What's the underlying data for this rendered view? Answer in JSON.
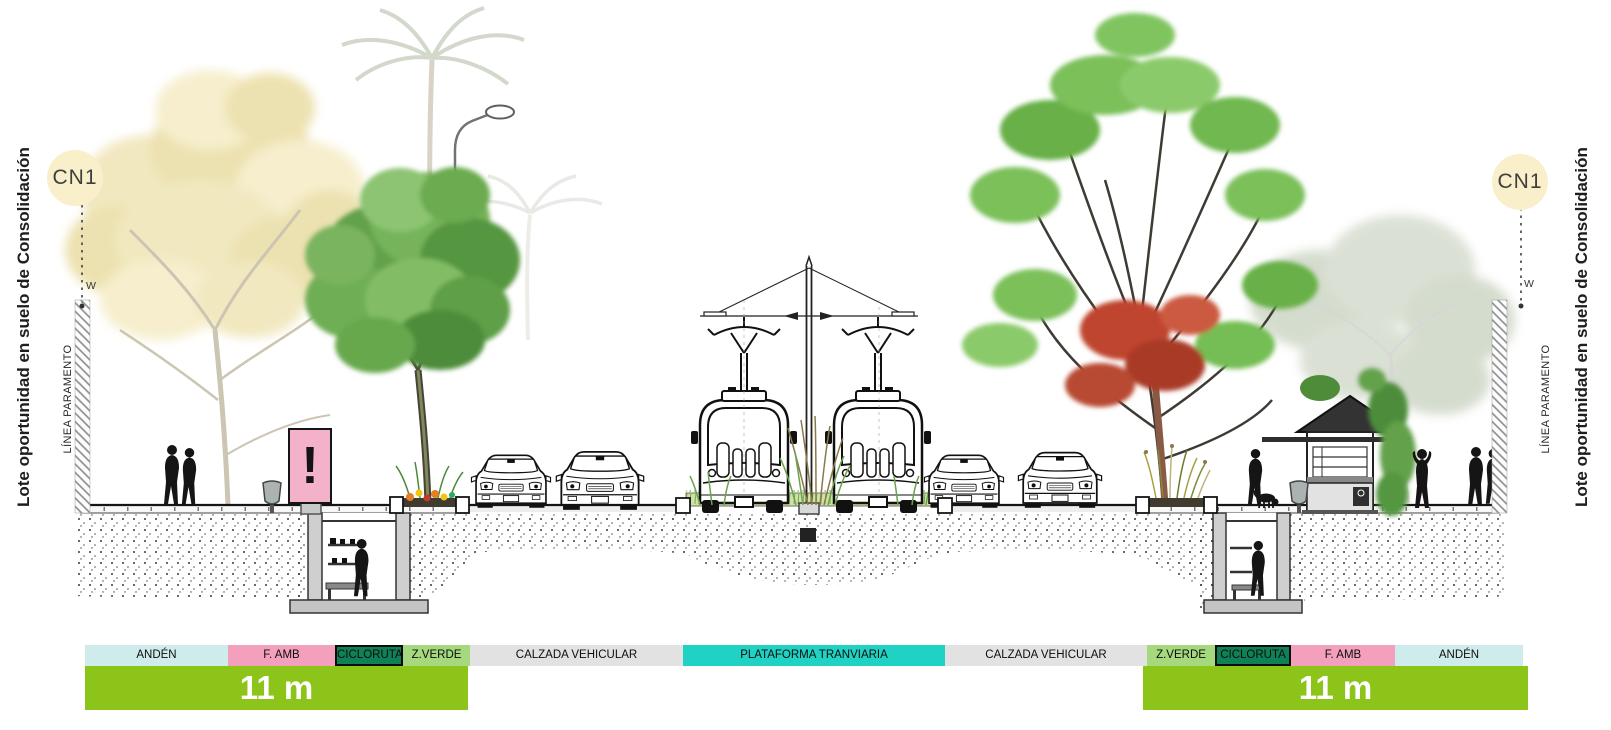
{
  "diagram": {
    "section_badges": {
      "left": "CN1",
      "right": "CN1"
    },
    "side_labels": {
      "left_lot": "Lote oportunidad en suelo de Consolidación",
      "right_lot": "Lote oportunidad en suelo de Consolidación",
      "left_paramento": "LÍNEA PARAMENTO",
      "right_paramento": "LÍNEA PARAMENTO",
      "left_w": "W",
      "right_w": "W"
    },
    "billboard": {
      "text": "!"
    },
    "zone_bar": {
      "segments": [
        {
          "label": "ANDÉN",
          "color": "#cfecec"
        },
        {
          "label": "F. AMB",
          "color": "#f2a0bb"
        },
        {
          "label": "CICLORUTA",
          "color": "#0f8157"
        },
        {
          "label": "Z.VERDE",
          "color": "#a6d97d"
        },
        {
          "label": "CALZADA VEHICULAR",
          "color": "#e2e2e2"
        },
        {
          "label": "PLATAFORMA TRANVIARIA",
          "color": "#1fd2c3"
        },
        {
          "label": "CALZADA VEHICULAR",
          "color": "#e2e2e2"
        },
        {
          "label": "Z.VERDE",
          "color": "#a6d97d"
        },
        {
          "label": "CICLORUTA",
          "color": "#0f8157"
        },
        {
          "label": "F. AMB",
          "color": "#f2a0bb"
        },
        {
          "label": "ANDÉN",
          "color": "#cfecec"
        }
      ]
    },
    "dimension_bars": {
      "left": {
        "label": "11 m",
        "color": "#8dc41a"
      },
      "right": {
        "label": "11 m",
        "color": "#8dc41a"
      }
    },
    "colors": {
      "badge_cream": "#f9efca",
      "billboard_pink": "#f4b1ca"
    }
  }
}
